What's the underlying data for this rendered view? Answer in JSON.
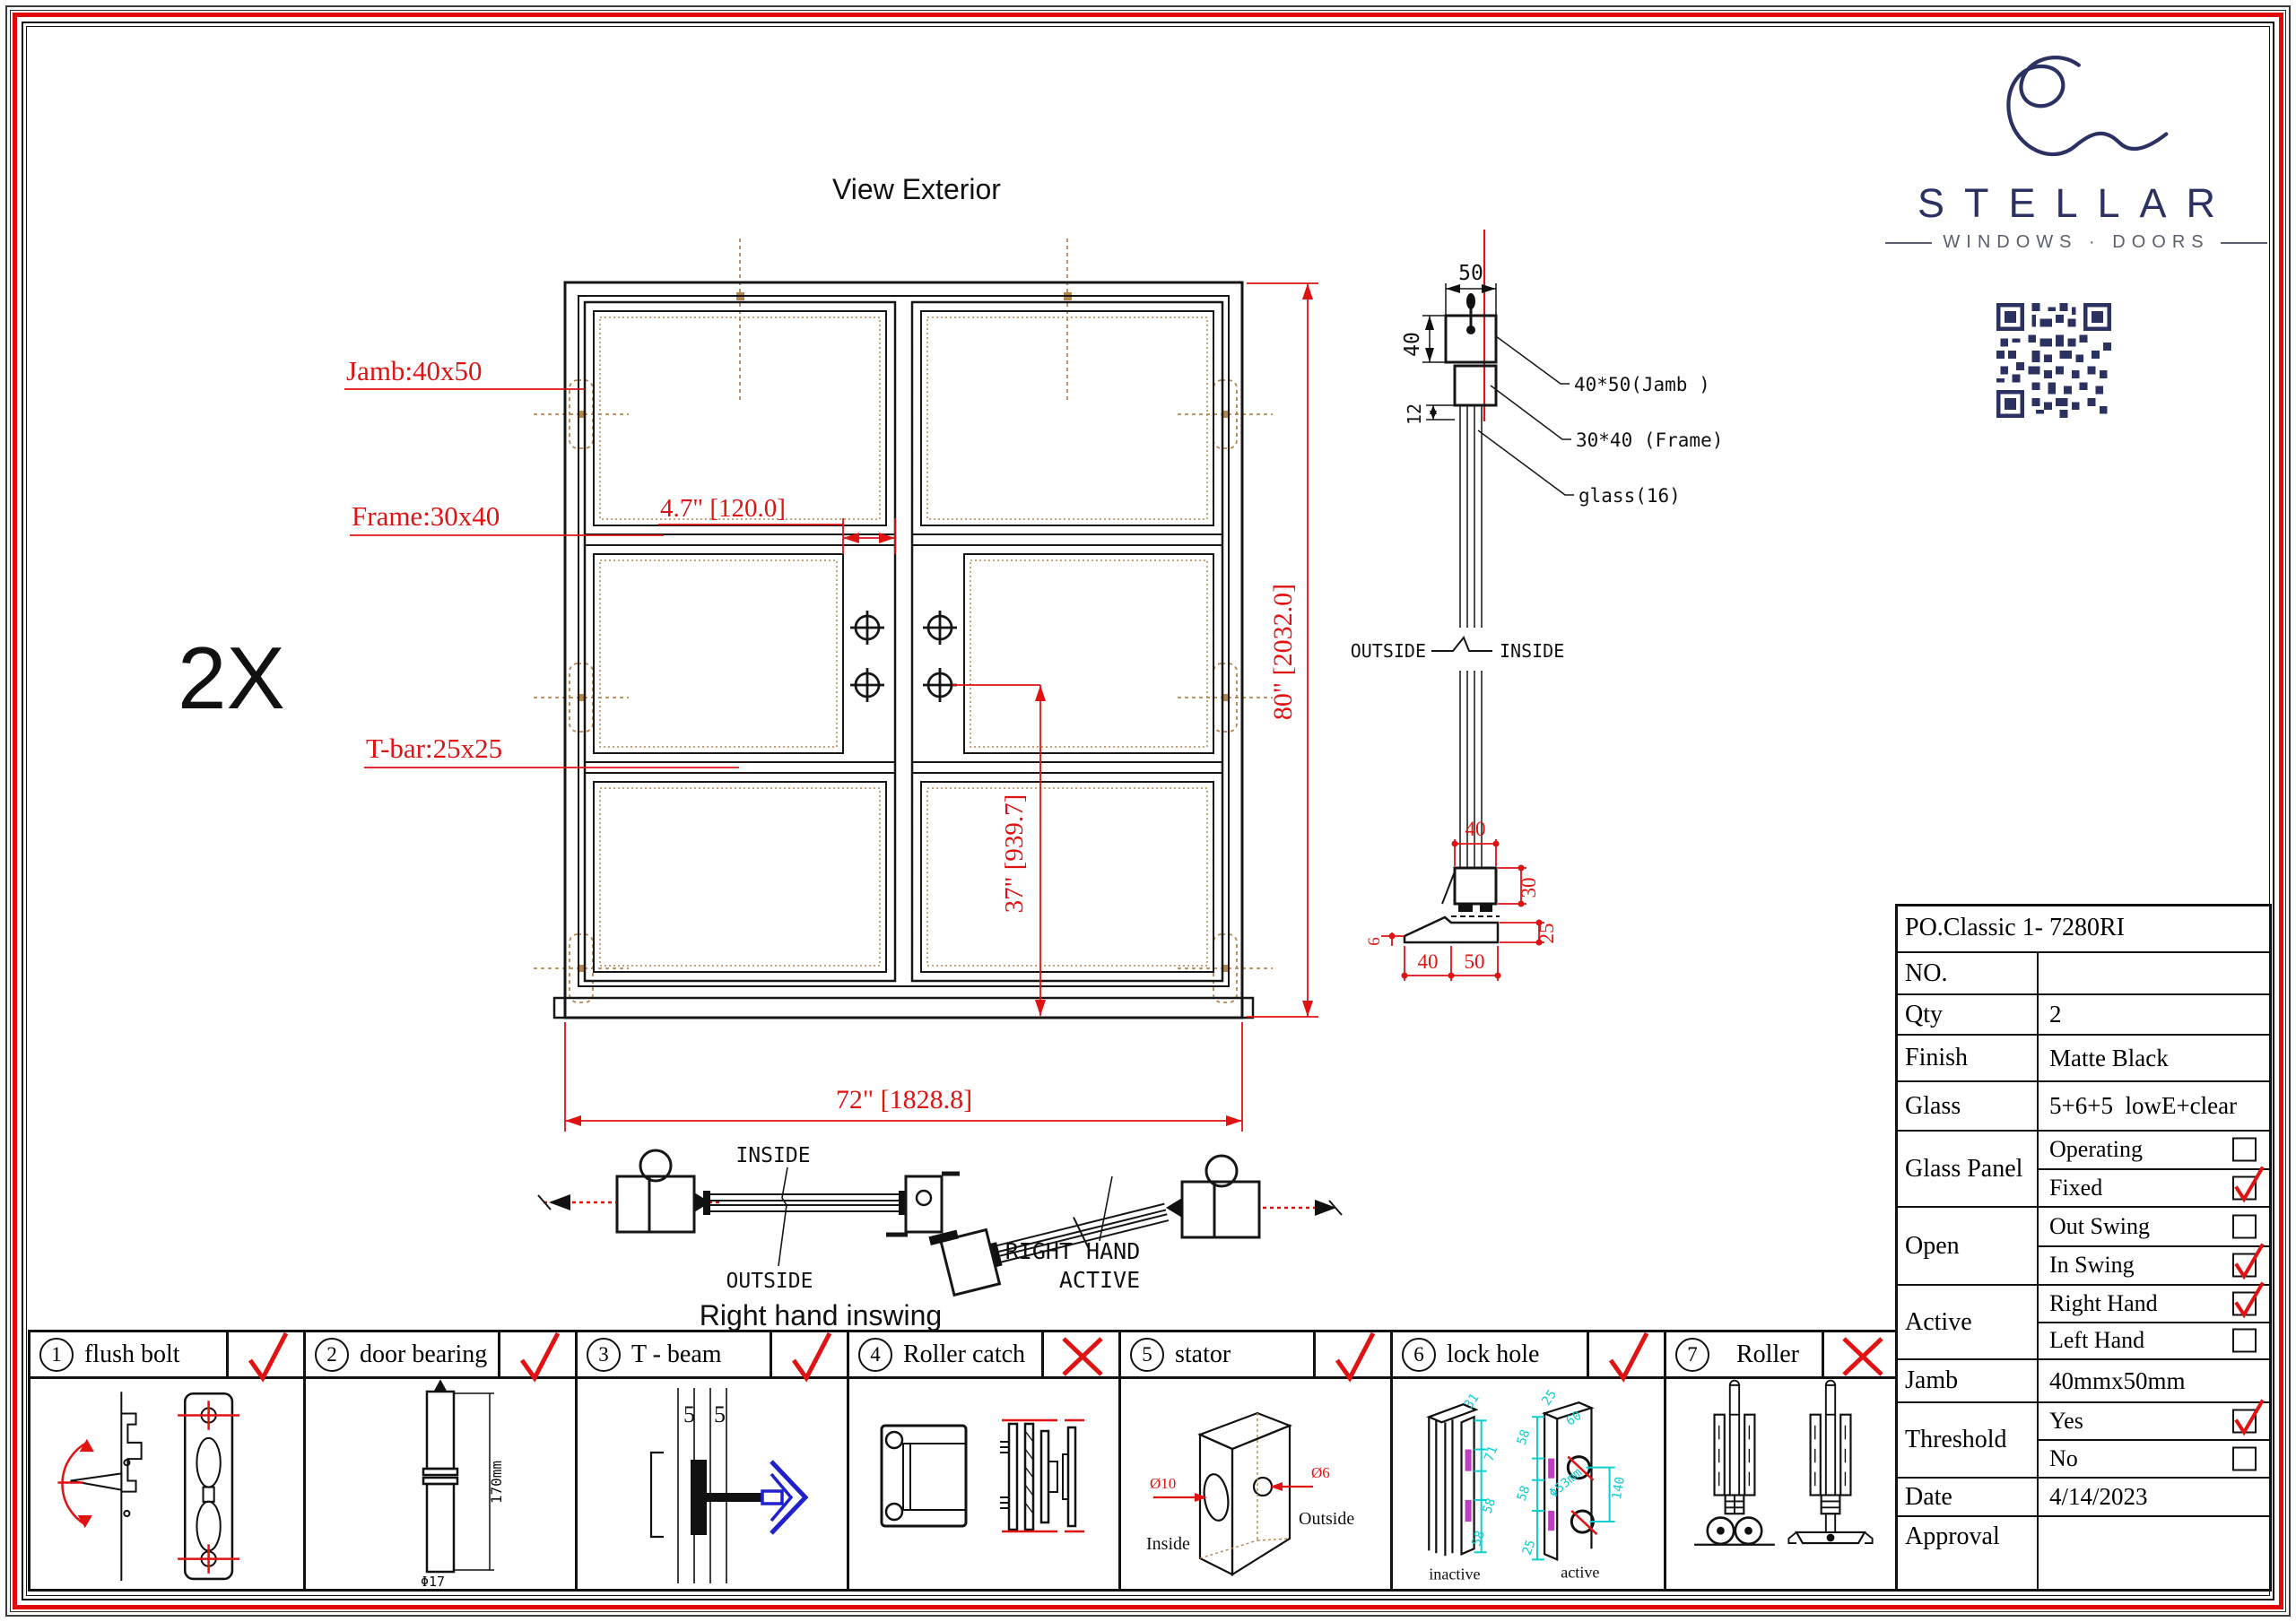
{
  "sheet": {
    "title": "View Exterior",
    "copies_marker": "2X",
    "plan_title": "Right hand inswing"
  },
  "logo": {
    "brand": "STELLAR",
    "tagline": "WINDOWS · DOORS"
  },
  "elevation": {
    "jamb_label": "Jamb:40x50",
    "frame_label": "Frame:30x40",
    "tbar_label": "T-bar:25x25",
    "dim_stile": "4.7\" [120.0]",
    "dim_handle": "37\" [939.7]",
    "dim_height": "80\" [2032.0]",
    "dim_width": "72\" [1828.8]"
  },
  "section": {
    "dim_50": "50",
    "dim_40": "40",
    "dim_12": "12",
    "label_jamb": "40*50(Jamb )",
    "label_frame": "30*40  (Frame)",
    "label_glass": "glass(16)",
    "outside": "OUTSIDE",
    "inside": "INSIDE",
    "sill": {
      "dim_top": "40",
      "dim_right": "30",
      "dim_right2": "25",
      "dim_left": "6",
      "dim_b40": "40",
      "dim_b50": "50"
    }
  },
  "plan": {
    "inside": "INSIDE",
    "outside": "OUTSIDE",
    "active_line1": "RIGHT HAND",
    "active_line2": "ACTIVE"
  },
  "hardware": [
    {
      "num": "1",
      "label": "flush bolt",
      "checked": true,
      "crossed": false
    },
    {
      "num": "2",
      "label": "door bearing",
      "checked": true,
      "crossed": false,
      "dim_length": "170mm",
      "dim_dia": "Φ17"
    },
    {
      "num": "3",
      "label": "T - beam",
      "checked": true,
      "crossed": false,
      "dim_left": "5",
      "dim_right": "5"
    },
    {
      "num": "4",
      "label": "Roller catch",
      "checked": false,
      "crossed": true
    },
    {
      "num": "5",
      "label": "stator",
      "checked": true,
      "crossed": false,
      "dia_big": "Ø10",
      "dia_small": "Ø6",
      "inside": "Inside",
      "outside": "Outside"
    },
    {
      "num": "6",
      "label": "lock hole",
      "checked": true,
      "crossed": false,
      "left_caption": "inactive",
      "right_caption": "active",
      "left_dims": [
        "31",
        "71",
        "58",
        "58"
      ],
      "right_dims": [
        "25",
        "60",
        "58",
        "58",
        "25",
        "140"
      ],
      "hole_dia": "Φ53mm"
    },
    {
      "num": "7",
      "label": "Roller",
      "checked": false,
      "crossed": true
    }
  ],
  "spec_table": {
    "po_number": "PO.Classic 1- 7280RI",
    "rows": [
      {
        "label": "NO.",
        "value": ""
      },
      {
        "label": "Qty",
        "value": "2"
      },
      {
        "label": "Finish",
        "value": "Matte Black"
      },
      {
        "label": "Glass",
        "value": "5+6+5  lowE+clear"
      },
      {
        "label": "Glass Panel",
        "options": [
          {
            "text": "Operating",
            "checked": false
          },
          {
            "text": "Fixed",
            "checked": true
          }
        ]
      },
      {
        "label": "Open",
        "options": [
          {
            "text": "Out Swing",
            "checked": false
          },
          {
            "text": "In Swing",
            "checked": true
          }
        ]
      },
      {
        "label": "Active",
        "options": [
          {
            "text": "Right Hand",
            "checked": true
          },
          {
            "text": "Left Hand",
            "checked": false
          }
        ]
      },
      {
        "label": "Jamb",
        "value": "40mmx50mm"
      },
      {
        "label": "Threshold",
        "options": [
          {
            "text": "Yes",
            "checked": true
          },
          {
            "text": "No",
            "checked": false
          }
        ]
      },
      {
        "label": "Date",
        "value": "4/14/2023"
      },
      {
        "label": "Approval",
        "value": ""
      }
    ]
  },
  "colors": {
    "red": "#e01212",
    "tan": "#b3874f",
    "navy": "#2b3160",
    "cyan": "#0ccfcf",
    "magenta": "#c03fc0",
    "blue": "#2020cc"
  }
}
